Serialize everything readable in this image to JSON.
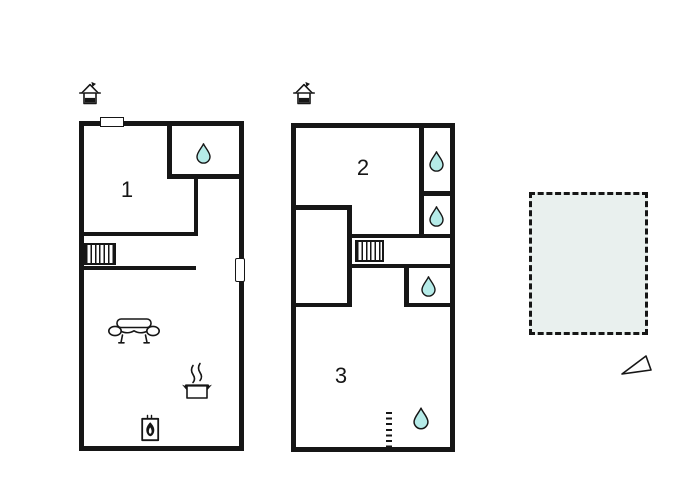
{
  "colors": {
    "bg": "#ffffff",
    "wall": "#161616",
    "drop-fill": "#b5ebe8",
    "terrace-fill": "#e9f0ee"
  },
  "rooms": {
    "room1": {
      "label": "1"
    },
    "room2": {
      "label": "2"
    },
    "room3": {
      "label": "3"
    }
  },
  "icons": {
    "entrance": "house-entrance-arrow",
    "bathroom": "water-drop",
    "sofa": "sofa-front-view",
    "kitchen": "steaming-pot",
    "heating": "fireplace-stove",
    "compass": "north-arrow-triangle"
  }
}
